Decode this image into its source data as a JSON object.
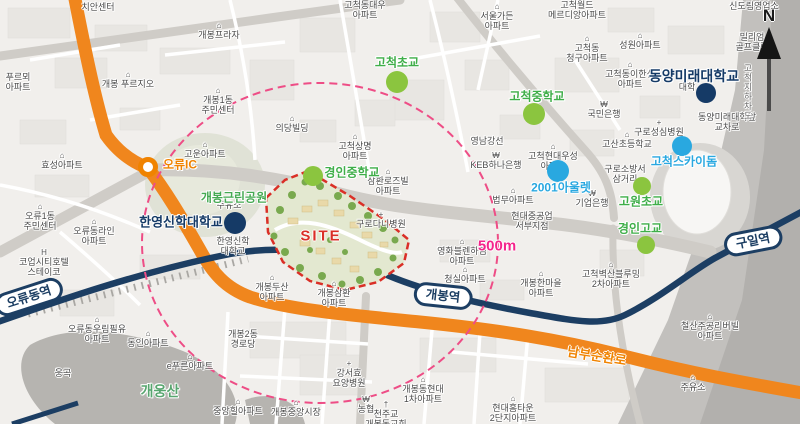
{
  "colors": {
    "accent_orange": "#f08300",
    "rail_navy": "#1c3e63",
    "school_green": "#3fae49",
    "poi_blue": "#29a8e0",
    "univ_navy": "#153a66",
    "site_red": "#da2f27",
    "radius_pink": "#ee4d86",
    "label_magenta": "#f4258c",
    "road_orange": "#f0861d"
  },
  "site": {
    "label": "SITE",
    "radius_label": "500m"
  },
  "compass": {
    "label": "N"
  },
  "stations": [
    {
      "name": "오류동역",
      "x": 29,
      "y": 297,
      "rot": -18
    },
    {
      "name": "개봉역",
      "x": 443,
      "y": 296,
      "rot": 6
    },
    {
      "name": "구일역",
      "x": 753,
      "y": 241,
      "rot": -11
    }
  ],
  "road_labels": [
    {
      "text": "남부순환로",
      "x": 597,
      "y": 355,
      "rot": 9,
      "color": "#f08300",
      "fs": 13
    }
  ],
  "landmarks": [
    {
      "id": "oryu-ic",
      "label": "오류IC",
      "lx": 180,
      "ly": 164,
      "color": "#f08300",
      "fs": 12,
      "dot": {
        "x": 148,
        "y": 167,
        "r": 9,
        "ring": true
      }
    },
    {
      "id": "gaebong-park",
      "label": "개봉근린공원",
      "lx": 234,
      "ly": 197,
      "color": "#45a952",
      "fs": 12
    },
    {
      "id": "hanyoung-univ",
      "label": "한영신학대학교",
      "lx": 181,
      "ly": 221,
      "color": "#153a66",
      "fs": 13,
      "dot": {
        "x": 235,
        "y": 223,
        "r": 11,
        "dc": "#153a66"
      }
    },
    {
      "id": "kyungin-middle",
      "label": "경인중학교",
      "lx": 352,
      "ly": 172,
      "color": "#3fae49",
      "fs": 12,
      "dot": {
        "x": 313,
        "y": 176,
        "r": 10,
        "dc": "#8bc53f"
      }
    },
    {
      "id": "gocheok-elem",
      "label": "고척초교",
      "lx": 397,
      "ly": 62,
      "color": "#3fae49",
      "fs": 12,
      "dot": {
        "x": 397,
        "y": 82,
        "r": 11,
        "dc": "#8bc53f"
      }
    },
    {
      "id": "gocheok-middle",
      "label": "고척중학교",
      "lx": 537,
      "ly": 96,
      "color": "#3fae49",
      "fs": 12,
      "dot": {
        "x": 534,
        "y": 114,
        "r": 11,
        "dc": "#8bc53f"
      }
    },
    {
      "id": "dongyang-univ",
      "label": "동양미래대학교",
      "lx": 694,
      "ly": 76,
      "color": "#153a66",
      "fs": 14,
      "dot": {
        "x": 706,
        "y": 93,
        "r": 10,
        "dc": "#153a66"
      }
    },
    {
      "id": "gocheok-skydome",
      "label": "고척스카이돔",
      "lx": 684,
      "ly": 161,
      "color": "#29a8e0",
      "fs": 12,
      "dot": {
        "x": 682,
        "y": 146,
        "r": 10,
        "dc": "#29a8e0"
      }
    },
    {
      "id": "outlet-2001",
      "label": "2001아울렛",
      "lx": 561,
      "ly": 187,
      "color": "#29a8e0",
      "fs": 12,
      "dot": {
        "x": 558,
        "y": 171,
        "r": 11,
        "dc": "#29a8e0"
      }
    },
    {
      "id": "gowon-elem",
      "label": "고원초교",
      "lx": 641,
      "ly": 201,
      "color": "#3fae49",
      "fs": 12,
      "dot": {
        "x": 642,
        "y": 186,
        "r": 9,
        "dc": "#8bc53f"
      }
    },
    {
      "id": "kyungin-high",
      "label": "경인고교",
      "lx": 640,
      "ly": 228,
      "color": "#3fae49",
      "fs": 12,
      "dot": {
        "x": 646,
        "y": 245,
        "r": 9,
        "dc": "#8bc53f"
      }
    },
    {
      "id": "gaeung-mountain",
      "label": "개웅산",
      "lx": 160,
      "ly": 391,
      "color": "#57a56e",
      "fs": 14
    }
  ],
  "places": [
    {
      "t": "치안센터",
      "x": 98,
      "y": 7
    },
    {
      "t": "개봉프라자",
      "x": 219,
      "y": 31,
      "icon": "b"
    },
    {
      "t": "개봉 푸르지오",
      "x": 128,
      "y": 80,
      "icon": "b"
    },
    {
      "t": "푸르뫼\n아파트",
      "x": 18,
      "y": 82
    },
    {
      "t": "개봉1동\n주민센터",
      "x": 218,
      "y": 101,
      "icon": "b"
    },
    {
      "t": "효성아파트",
      "x": 62,
      "y": 161,
      "icon": "b"
    },
    {
      "t": "오류1동\n주민센터",
      "x": 40,
      "y": 217,
      "icon": "b"
    },
    {
      "t": "오류동라인\n아파트",
      "x": 94,
      "y": 232,
      "icon": "b"
    },
    {
      "t": "코업시티호텔\n스테이코",
      "x": 44,
      "y": 263,
      "icon": "h"
    },
    {
      "t": "고운아파트",
      "x": 205,
      "y": 150,
      "icon": "b"
    },
    {
      "t": "오류동우림필유\n아파트",
      "x": 97,
      "y": 330,
      "icon": "b"
    },
    {
      "t": "동인아파트",
      "x": 148,
      "y": 339,
      "icon": "b"
    },
    {
      "t": "e푸른아파트",
      "x": 190,
      "y": 362,
      "icon": "b"
    },
    {
      "t": "웅곡",
      "x": 63,
      "y": 373
    },
    {
      "t": "개봉두산\n아파트",
      "x": 272,
      "y": 288,
      "icon": "b"
    },
    {
      "t": "개봉삼환\n아파트",
      "x": 334,
      "y": 294,
      "icon": "b"
    },
    {
      "t": "개봉2동\n경로당",
      "x": 243,
      "y": 339
    },
    {
      "t": "중앙힐아파트",
      "x": 238,
      "y": 407,
      "icon": "b"
    },
    {
      "t": "개봉중앙시장",
      "x": 296,
      "y": 408,
      "icon": "b"
    },
    {
      "t": "강서효\n요양병원",
      "x": 349,
      "y": 374,
      "icon": "+"
    },
    {
      "t": "농협",
      "x": 366,
      "y": 405,
      "icon": "w"
    },
    {
      "t": "천주교\n개봉동교회",
      "x": 386,
      "y": 415,
      "icon": "c"
    },
    {
      "t": "개봉동현대\n1차아파트",
      "x": 423,
      "y": 390,
      "icon": "b"
    },
    {
      "t": "현대홈타운\n2단지아파트",
      "x": 513,
      "y": 409,
      "icon": "b"
    },
    {
      "t": "개봉한마을\n아파트",
      "x": 541,
      "y": 284,
      "icon": "b"
    },
    {
      "t": "청실아파트",
      "x": 465,
      "y": 275,
      "icon": "b"
    },
    {
      "t": "영화블렌하임\n아파트",
      "x": 462,
      "y": 252,
      "icon": "b"
    },
    {
      "t": "고척벽산블루밍\n2차아파트",
      "x": 611,
      "y": 275,
      "icon": "b"
    },
    {
      "t": "철산주공리버빌\n아파트",
      "x": 710,
      "y": 327,
      "icon": "b"
    },
    {
      "t": "주유소",
      "x": 693,
      "y": 383,
      "icon": "b"
    },
    {
      "t": "한영신학\n대학교",
      "x": 233,
      "y": 246
    },
    {
      "t": "주유소",
      "x": 229,
      "y": 205
    },
    {
      "t": "고척동대우\n아파트",
      "x": 365,
      "y": 10
    },
    {
      "t": "서울가든\n아파트",
      "x": 497,
      "y": 17,
      "icon": "b"
    },
    {
      "t": "고척월드\n메르디앙아파트",
      "x": 577,
      "y": 10
    },
    {
      "t": "의당빌딩",
      "x": 292,
      "y": 124,
      "icon": "b"
    },
    {
      "t": "고척상명\n아파트",
      "x": 355,
      "y": 147,
      "icon": "b"
    },
    {
      "t": "삼환로즈빌\n아파트",
      "x": 388,
      "y": 182,
      "icon": "b"
    },
    {
      "t": "구로다니병원",
      "x": 381,
      "y": 220,
      "icon": "+"
    },
    {
      "t": "영남강선",
      "x": 487,
      "y": 141
    },
    {
      "t": "KEB하나은행",
      "x": 496,
      "y": 161,
      "icon": "w"
    },
    {
      "t": "고척현대우성\n아파트",
      "x": 553,
      "y": 157,
      "icon": "b"
    },
    {
      "t": "법무아파트",
      "x": 513,
      "y": 196,
      "icon": "b"
    },
    {
      "t": "현대중공업\n서부지점",
      "x": 532,
      "y": 221
    },
    {
      "t": "기업은행",
      "x": 592,
      "y": 199,
      "icon": "w"
    },
    {
      "t": "구로소방서\n삼거리",
      "x": 625,
      "y": 174
    },
    {
      "t": "국민은행",
      "x": 604,
      "y": 110,
      "icon": "w"
    },
    {
      "t": "구로성심병원",
      "x": 659,
      "y": 128,
      "icon": "+"
    },
    {
      "t": "고산초등학교",
      "x": 627,
      "y": 140,
      "icon": "b"
    },
    {
      "t": "성원아파트",
      "x": 640,
      "y": 41,
      "icon": "b"
    },
    {
      "t": "고척동\n청구아파트",
      "x": 587,
      "y": 49,
      "icon": "b"
    },
    {
      "t": "고척동이한신\n아파트",
      "x": 630,
      "y": 75,
      "icon": "b"
    },
    {
      "t": "대학",
      "x": 687,
      "y": 87
    },
    {
      "t": "동양미래대학앞\n교차로",
      "x": 727,
      "y": 122
    },
    {
      "t": "신도림영업소",
      "x": 754,
      "y": 6
    },
    {
      "t": "밀리엄\n골프클럽",
      "x": 752,
      "y": 42
    },
    {
      "t": "고척지하차도",
      "x": 748,
      "y": 92,
      "vertical": true
    }
  ]
}
